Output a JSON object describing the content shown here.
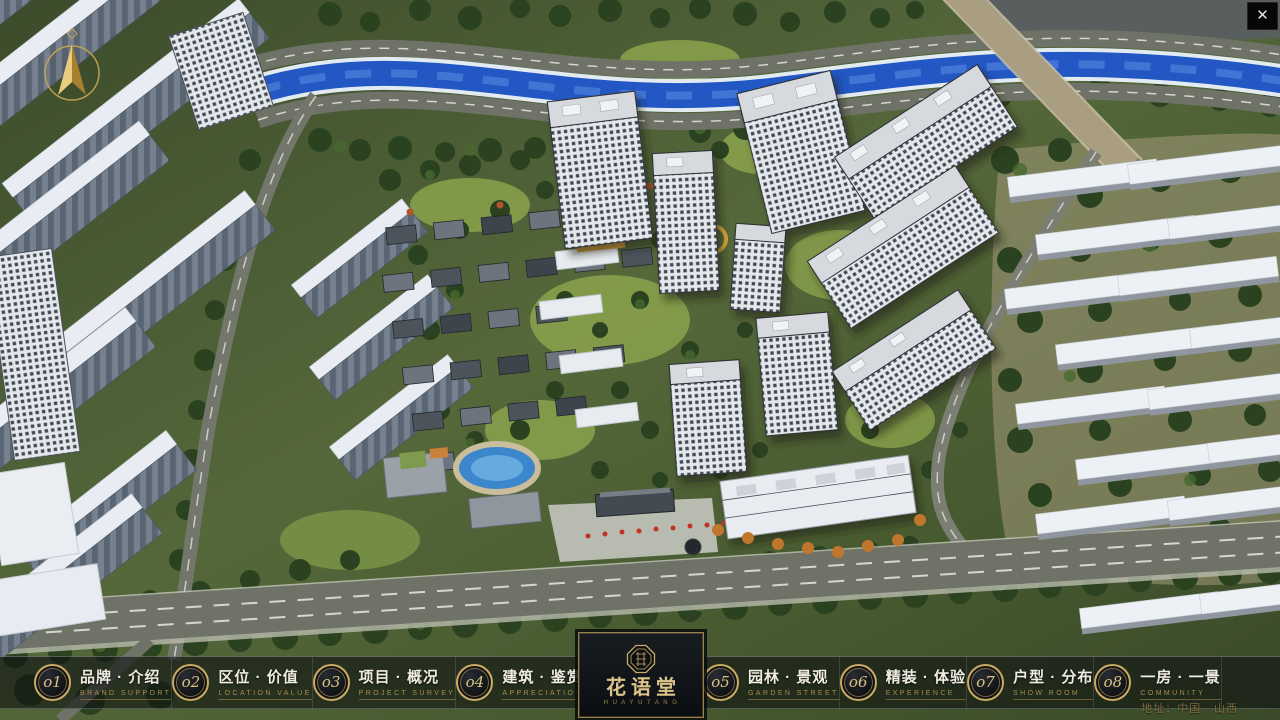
{
  "window": {
    "close_label": "✕"
  },
  "logo": {
    "name": "花语堂",
    "subtitle": "H U A Y U T A N G"
  },
  "navbar": {
    "address": "地址：中国 · 山西",
    "items": [
      {
        "num": "o1",
        "label": "品牌 · 介绍",
        "sub": "BRAND SUPPORT"
      },
      {
        "num": "o2",
        "label": "区位 · 价值",
        "sub": "LOCATION VALUE"
      },
      {
        "num": "o3",
        "label": "项目 · 概况",
        "sub": "PROJECT SURVEY"
      },
      {
        "num": "o4",
        "label": "建筑 · 鉴赏",
        "sub": "APPRECIATION"
      },
      {
        "num": "o5",
        "label": "园林 · 景观",
        "sub": "GARDEN STREET"
      },
      {
        "num": "o6",
        "label": "精装 · 体验",
        "sub": "EXPERIENCE"
      },
      {
        "num": "o7",
        "label": "户型 · 分布",
        "sub": "SHOW ROOM"
      },
      {
        "num": "o8",
        "label": "一房 · 一景",
        "sub": "COMMUNITY"
      }
    ]
  },
  "colors": {
    "accent_gold": "#c9ab63",
    "river_blue": "#2257c4",
    "bar_bg": "rgba(10,12,14,0.55)"
  }
}
